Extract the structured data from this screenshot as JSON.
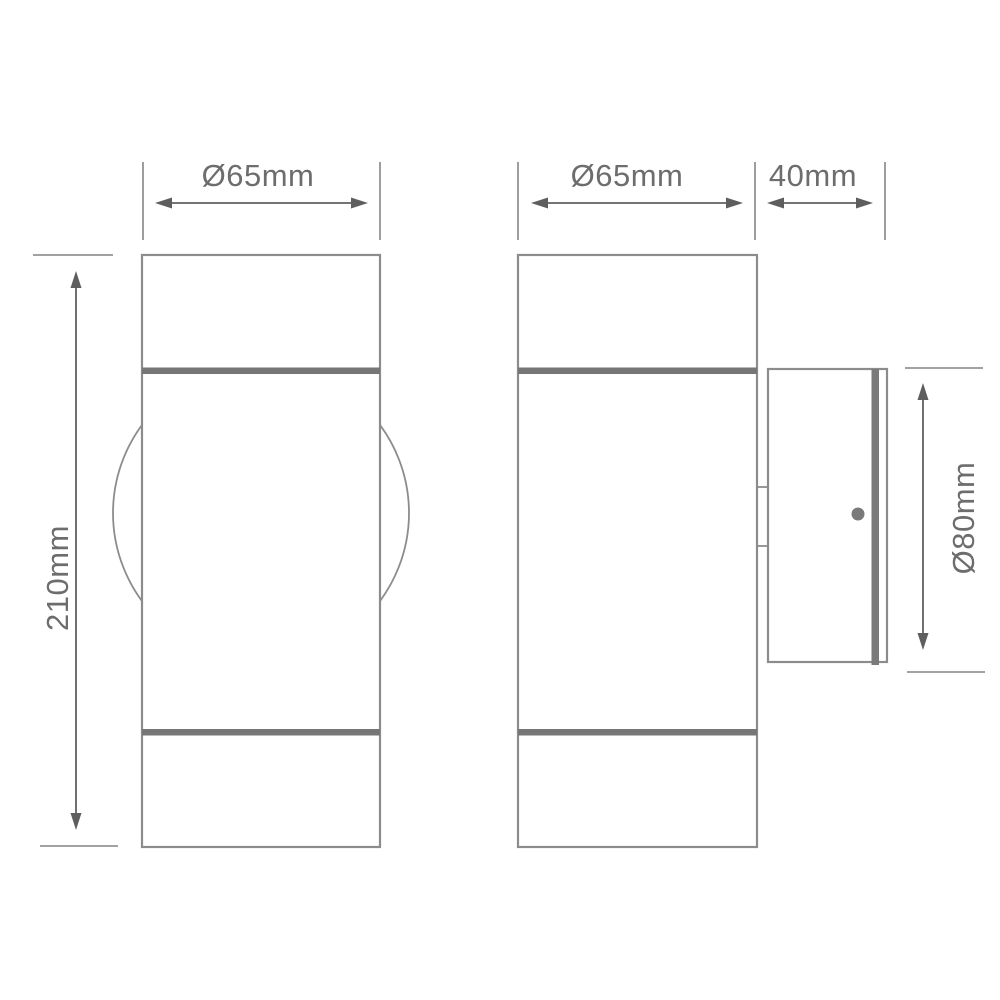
{
  "drawing": {
    "dimensions": {
      "front_diameter": "Ø65mm",
      "front_height": "210mm",
      "side_diameter": "Ø65mm",
      "bracket_depth": "40mm",
      "backplate_diameter": "Ø80mm"
    },
    "colors": {
      "background": "#ffffff",
      "outline": "#8c8c8c",
      "extension_line": "#949494",
      "dimension_line": "#616161",
      "trim_band": "#767676",
      "stripe": "#7a7a7a",
      "screw_dot": "#7a7a7a",
      "text": "#6d6d6d"
    }
  }
}
